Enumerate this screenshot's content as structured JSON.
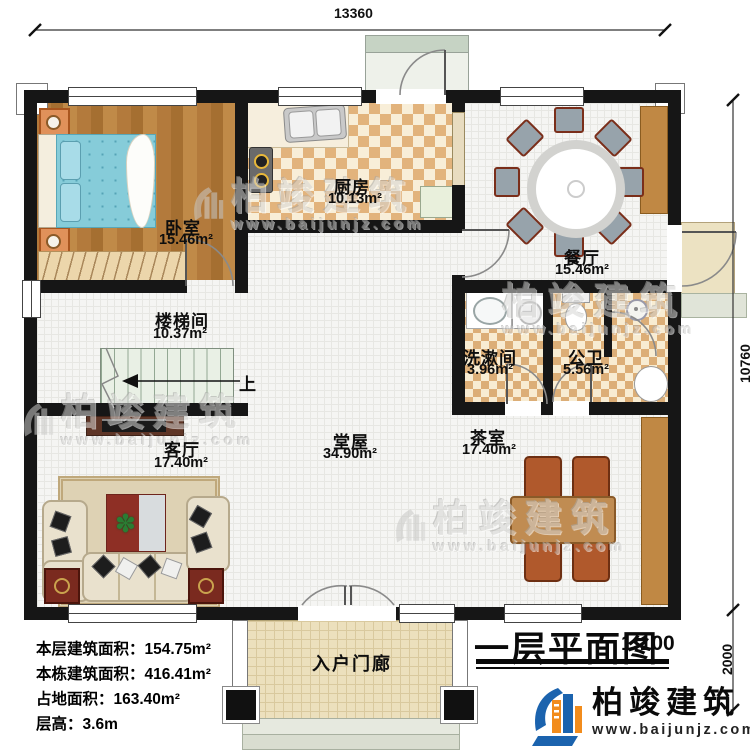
{
  "dims": {
    "top": "13360",
    "right_upper": "10760",
    "right_lower": "2000"
  },
  "rooms": {
    "bedroom": {
      "name": "卧室",
      "area": "15.46m²"
    },
    "kitchen": {
      "name": "厨房",
      "area": "10.13m²"
    },
    "dining": {
      "name": "餐厅",
      "area": "15.46m²"
    },
    "stairwell": {
      "name": "楼梯间",
      "area": "10.37m²"
    },
    "washroom": {
      "name": "洗漱间",
      "area": "3.96m²"
    },
    "bathroom": {
      "name": "公卫",
      "area": "5.56m²"
    },
    "living": {
      "name": "客厅",
      "area": "17.40m²"
    },
    "hall": {
      "name": "堂屋",
      "area": "34.90m²"
    },
    "tearoom": {
      "name": "茶室",
      "area": "17.40m²"
    },
    "entry_porch": {
      "name": "入户门廊"
    }
  },
  "stairs": {
    "up_label": "上"
  },
  "info": {
    "floor_area_label": "本层建筑面积：",
    "floor_area": "154.75m²",
    "total_area_label": "本栋建筑面积：",
    "total_area": "416.41m²",
    "footprint_label": "占地面积：",
    "footprint": "163.40m²",
    "height_label": "层高：",
    "height": "3.6m"
  },
  "title_block": {
    "title": "一层平面图",
    "scale": "1:100"
  },
  "brand": {
    "name": "柏竣建筑",
    "url": "www.baijunjz.com"
  },
  "watermark": {
    "name": "柏竣建筑",
    "url": "www.baijunjz.com"
  },
  "colors": {
    "wall": "#161616",
    "brand_blue": "#1b63ae",
    "brand_orange": "#f28c1c"
  }
}
